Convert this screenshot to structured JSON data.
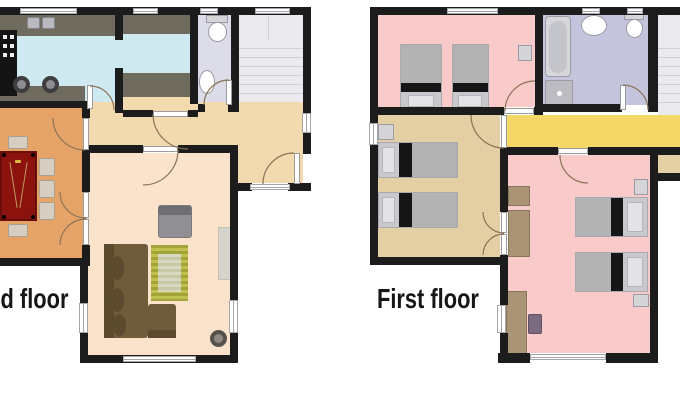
{
  "labels": {
    "ground": "Ground floor",
    "first": "First floor"
  },
  "palette": {
    "wall": "#1c1c1c",
    "kitchen": "#cfe9f0",
    "counter": "#6f6b5f",
    "wc": "#dcdce8",
    "bath": "#c5c4dd",
    "stairs": "#ebebef",
    "stairStep": "#cfcfd6",
    "hallway1": "#f3d9ae",
    "dining": "#e5a368",
    "table": "#8c130d",
    "tableEdge": "#6a0e09",
    "tableLine": "#c09a5e",
    "chair": "#d6cec0",
    "chairEdge": "#aaa193",
    "living": "#fbe3cb",
    "sofa": "#6f5c3b",
    "sofaDark": "#5b4a2e",
    "rug": "#a3a438",
    "rugLight": "#c0c14f",
    "rugInner": "#d8d8c2",
    "rugInnerStripe": "#c8c9a4",
    "armchair": "#8f8f94",
    "armchairDark": "#6d6d72",
    "stone": "#d6d3ca",
    "pouf": "#57524b",
    "poufInner": "#8d8780",
    "pink": "#f8caca",
    "tanroom": "#e4cfa4",
    "yellow": "#f3d767",
    "bedMattress": "#b3b3b3",
    "bedBlack": "#161616",
    "bedFrame": "#c9c9cd",
    "pillow": "#e3e3e6",
    "pillowEdge": "#b5b5bc",
    "wood": "#aa9476",
    "woodEdge": "#8a7757",
    "chairPurple": "#7c6a80",
    "fixture": "#ffffff",
    "fixtureBorder": "#9b9ba6",
    "tub": "#d7d7db",
    "tubInner": "#c4c4cb",
    "washer": "#bcbcc2",
    "applianceBlack": "#141414",
    "sinkSquare": "#b9b9bf",
    "nightstand": "#d5d5d8",
    "winFrame": "#a5a5ab",
    "arc": "#8a7356",
    "stool": "#3e3e40",
    "stoolInner": "#8e8e90",
    "text": "#161616"
  },
  "floors": [
    {
      "label": "Ground floor",
      "rooms": [
        "kitchen",
        "pantry",
        "wc",
        "staircase",
        "hallway",
        "dining-room",
        "living-room"
      ],
      "furniture": [
        "kitchen-counter",
        "stove",
        "kitchen-sink",
        "bar-stool",
        "bar-stool",
        "toilet",
        "washbasin",
        "dining-table",
        "chair",
        "chair",
        "chair",
        "chair",
        "chair",
        "corner-sofa",
        "armchair",
        "rug",
        "side-board",
        "pouf"
      ]
    },
    {
      "label": "First floor",
      "rooms": [
        "bedroom-1",
        "bathroom",
        "staircase",
        "hallway",
        "bedroom-2",
        "bedroom-3",
        "balcony"
      ],
      "furniture": [
        "single-bed",
        "single-bed",
        "nightstand",
        "bathtub",
        "washing-machine",
        "washbasin",
        "toilet",
        "single-bed",
        "single-bed",
        "nightstand",
        "wardrobe",
        "wardrobe",
        "desk",
        "desk-chair",
        "single-bed",
        "single-bed",
        "nightstand",
        "nightstand"
      ]
    }
  ]
}
